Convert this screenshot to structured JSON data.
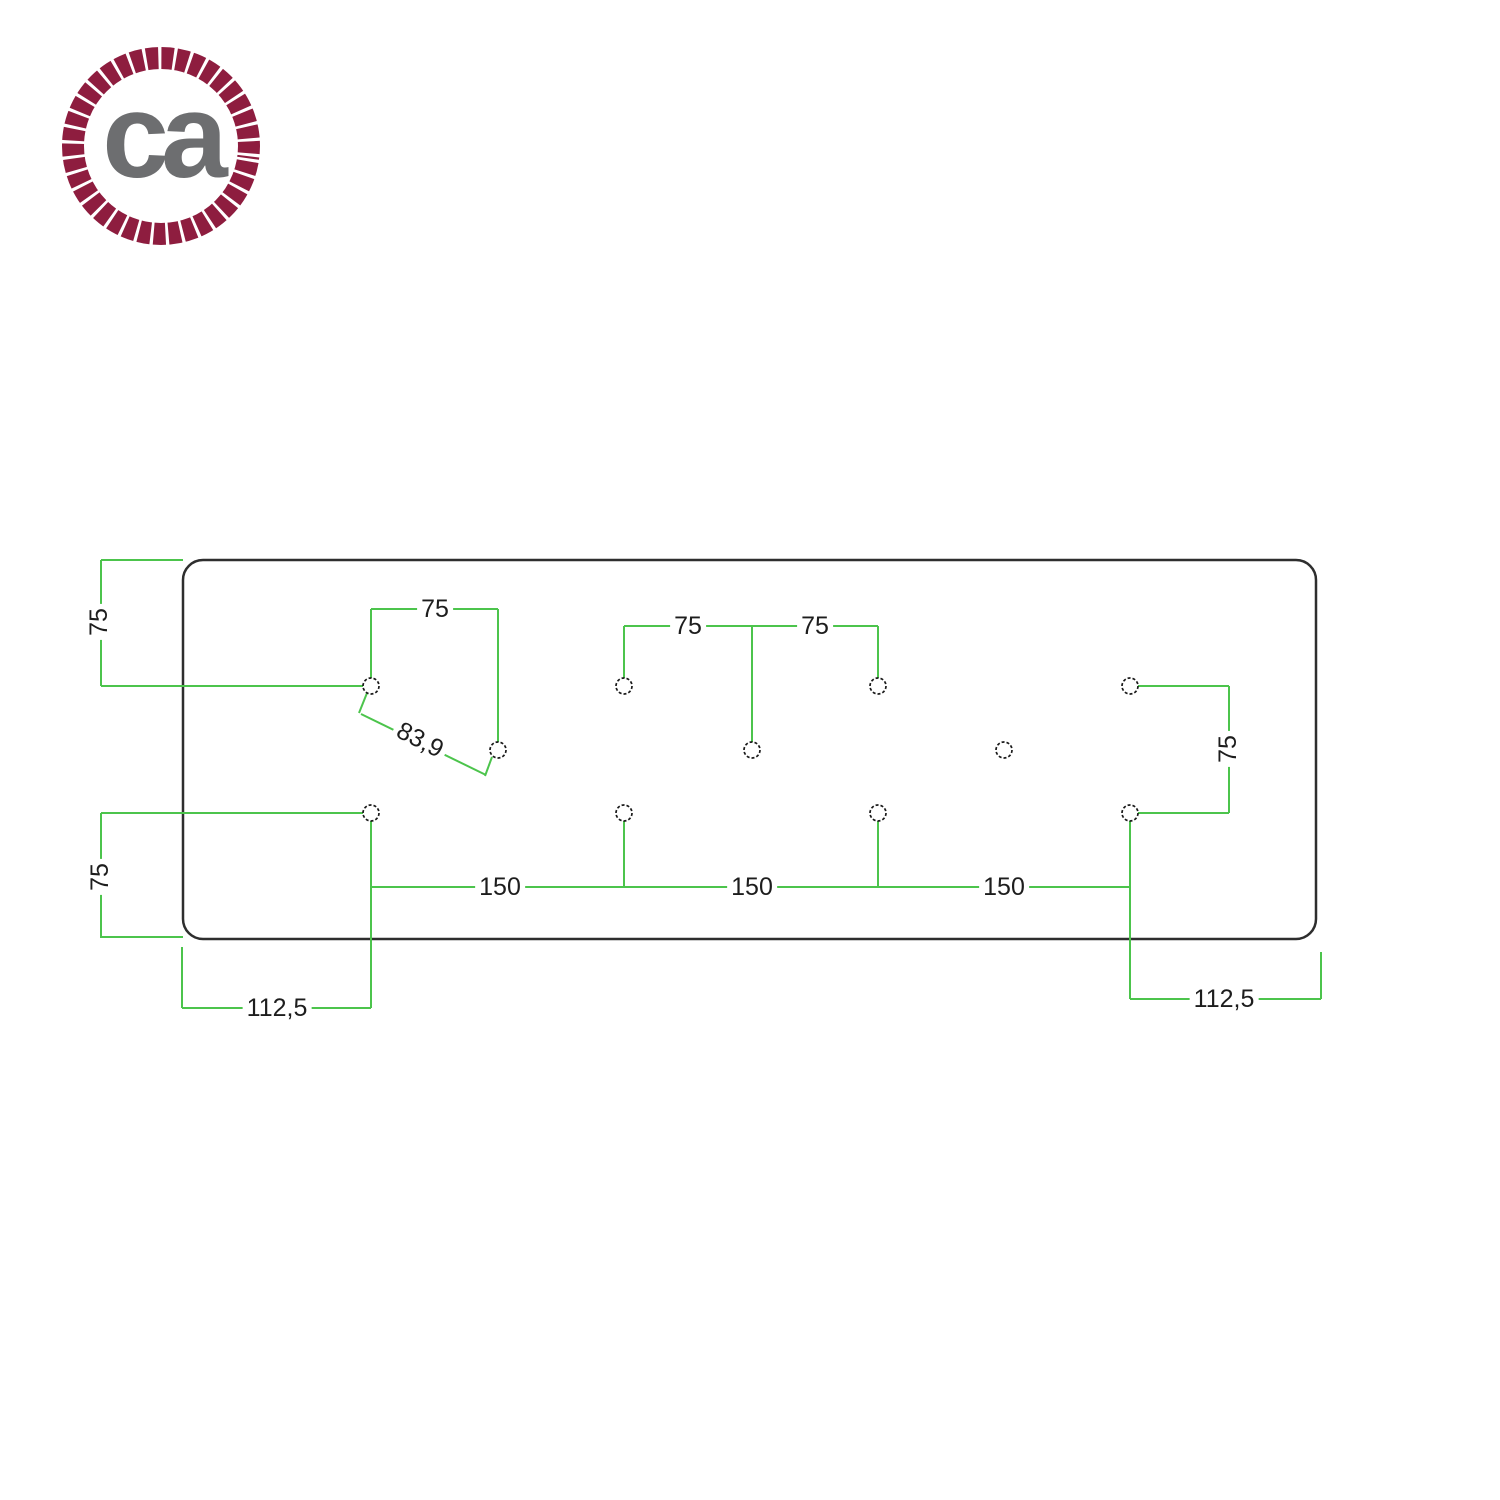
{
  "logo": {
    "text": "ca",
    "rope_color": "#8e1d3f",
    "text_color": "#6d6e70"
  },
  "drawing": {
    "colors": {
      "dimension_line": "#4cc44c",
      "plate_outline": "#2e2e2e",
      "hole_outline": "#1a1a1a",
      "label_text": "#1d1d1d"
    },
    "plate": {
      "x": 183,
      "y": 560,
      "width": 1133,
      "height": 379,
      "corner_radius": 20
    },
    "hole_radius": 8,
    "holes": [
      [
        371,
        686
      ],
      [
        624,
        686
      ],
      [
        878,
        686
      ],
      [
        1130,
        686
      ],
      [
        498,
        750
      ],
      [
        752,
        750
      ],
      [
        1004,
        750
      ],
      [
        371,
        813
      ],
      [
        624,
        813
      ],
      [
        878,
        813
      ],
      [
        1130,
        813
      ]
    ],
    "segments": [
      [
        101,
        560,
        101,
        686
      ],
      [
        101,
        560,
        183,
        560
      ],
      [
        101,
        686,
        363,
        686
      ],
      [
        101,
        813,
        101,
        938
      ],
      [
        101,
        813,
        363,
        813
      ],
      [
        101,
        937,
        183,
        937
      ],
      [
        371,
        609,
        498,
        609
      ],
      [
        371,
        609,
        371,
        678
      ],
      [
        498,
        609,
        498,
        742
      ],
      [
        624,
        626,
        878,
        626
      ],
      [
        624,
        626,
        624,
        678
      ],
      [
        752,
        626,
        752,
        742
      ],
      [
        878,
        626,
        878,
        678
      ],
      [
        1138,
        686,
        1229,
        686
      ],
      [
        1138,
        813,
        1229,
        813
      ],
      [
        1229,
        686,
        1229,
        813
      ],
      [
        367,
        693,
        359,
        713
      ],
      [
        492,
        757,
        485,
        776
      ],
      [
        361,
        714,
        486,
        775
      ],
      [
        371,
        887,
        1130,
        887
      ],
      [
        371,
        821,
        371,
        1008
      ],
      [
        624,
        821,
        624,
        887
      ],
      [
        878,
        821,
        878,
        887
      ],
      [
        1130,
        821,
        1130,
        999
      ],
      [
        182,
        947,
        182,
        1008
      ],
      [
        182,
        1008,
        371,
        1008
      ],
      [
        1321,
        952,
        1321,
        999
      ],
      [
        1130,
        999,
        1321,
        999
      ]
    ],
    "labels": [
      {
        "name": "dim-75-left-top",
        "text": "75",
        "x": 99,
        "y": 622,
        "rot": -90
      },
      {
        "name": "dim-75-left-bottom",
        "text": "75",
        "x": 100,
        "y": 877,
        "rot": -90
      },
      {
        "name": "dim-75-top-first",
        "text": "75",
        "x": 435,
        "y": 609,
        "rot": 0
      },
      {
        "name": "dim-75-center-left",
        "text": "75",
        "x": 688,
        "y": 626,
        "rot": 0
      },
      {
        "name": "dim-75-center-right",
        "text": "75",
        "x": 815,
        "y": 626,
        "rot": 0
      },
      {
        "name": "dim-83-9-diagonal",
        "text": "83,9",
        "x": 420,
        "y": 740,
        "rot": 27
      },
      {
        "name": "dim-75-right",
        "text": "75",
        "x": 1228,
        "y": 749,
        "rot": -90
      },
      {
        "name": "dim-150-left",
        "text": "150",
        "x": 500,
        "y": 887,
        "rot": 0
      },
      {
        "name": "dim-150-center",
        "text": "150",
        "x": 752,
        "y": 887,
        "rot": 0
      },
      {
        "name": "dim-150-right",
        "text": "150",
        "x": 1004,
        "y": 887,
        "rot": 0
      },
      {
        "name": "dim-112-5-left",
        "text": "112,5",
        "x": 277,
        "y": 1008,
        "rot": 0
      },
      {
        "name": "dim-112-5-right",
        "text": "112,5",
        "x": 1224,
        "y": 999,
        "rot": 0
      }
    ]
  }
}
